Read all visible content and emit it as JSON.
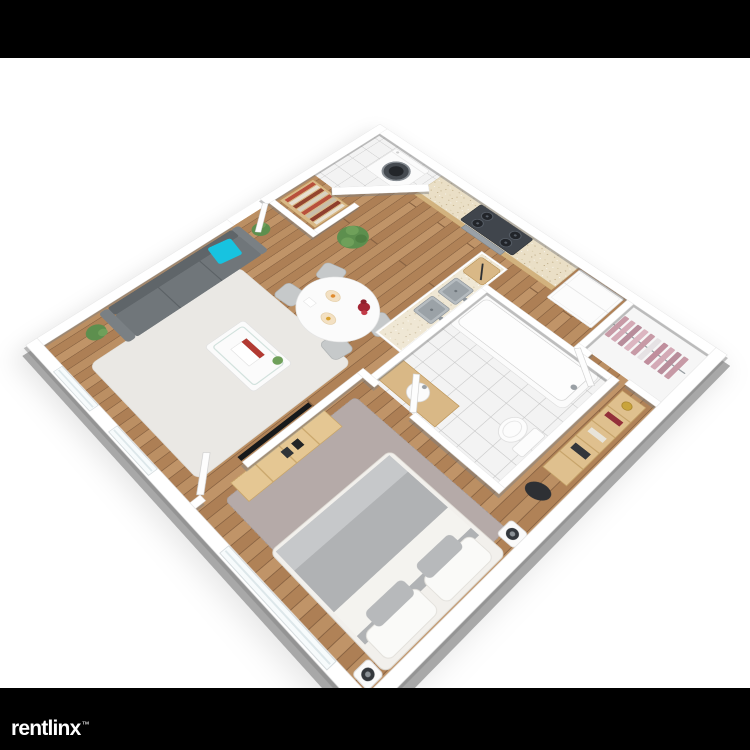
{
  "branding": {
    "logo_text": "rentlinx",
    "trademark_symbol": "™",
    "logo_color": "#ffffff",
    "bar_color": "#000000"
  },
  "frame": {
    "background": "#ffffff",
    "top_bar_height_px": 58,
    "bottom_bar_height_px": 62
  },
  "floor_plan": {
    "style": "3D isometric one-bedroom apartment render",
    "rooms": [
      {
        "name": "Living Room",
        "floor": "hardwood",
        "items": [
          "gray sofa",
          "cyan throw pillow",
          "black-and-white wall art",
          "white area rug",
          "coffee table with magazine and plant",
          "potted plants",
          "wall-mounted TV",
          "entry bookshelf with books"
        ]
      },
      {
        "name": "Dining Area",
        "floor": "hardwood",
        "items": [
          "white oval dining table",
          "four gray chairs",
          "red flower centerpiece",
          "place settings"
        ]
      },
      {
        "name": "Kitchen",
        "floor": "hardwood",
        "items": [
          "wood cabinets with speckled countertop",
          "gas stove with oven",
          "white refrigerator",
          "island with double stainless sink",
          "cutting board with knife"
        ]
      },
      {
        "name": "Laundry Nook",
        "floor": "white tile",
        "items": [
          "washing machine"
        ]
      },
      {
        "name": "Closet",
        "floor": "white",
        "items": [
          "pink clothes on hanging rail"
        ]
      },
      {
        "name": "Bathroom",
        "floor": "white tile",
        "items": [
          "bathtub",
          "toilet",
          "wood vanity with sink",
          "door"
        ]
      },
      {
        "name": "Hallway",
        "floor": "hardwood",
        "items": [
          "wood shelving unit",
          "dark bag on floor"
        ]
      },
      {
        "name": "Bedroom",
        "floor": "hardwood",
        "items": [
          "double bed with gray and white bedding",
          "white and gray pillows",
          "gray shag rug",
          "wood dresser with speakers",
          "two bedside lamps",
          "wide window"
        ]
      }
    ],
    "palette": {
      "wood_floor": "#b5895f",
      "wall_top": "#ffffff",
      "wall_side": "#a8a8a8",
      "tile": "#f3f3f3",
      "sofa_gray": "#70767a",
      "accent_cyan": "#17c3e0",
      "cabinet_wood": "#ddc08f",
      "stove_dark": "#40454c",
      "clothes_pink": "#c79aa6",
      "bedding_gray": "#b0b2b4",
      "living_rug": "#eae8e4",
      "bedroom_rug": "#b5aaa8",
      "flower_red": "#a32433"
    }
  }
}
